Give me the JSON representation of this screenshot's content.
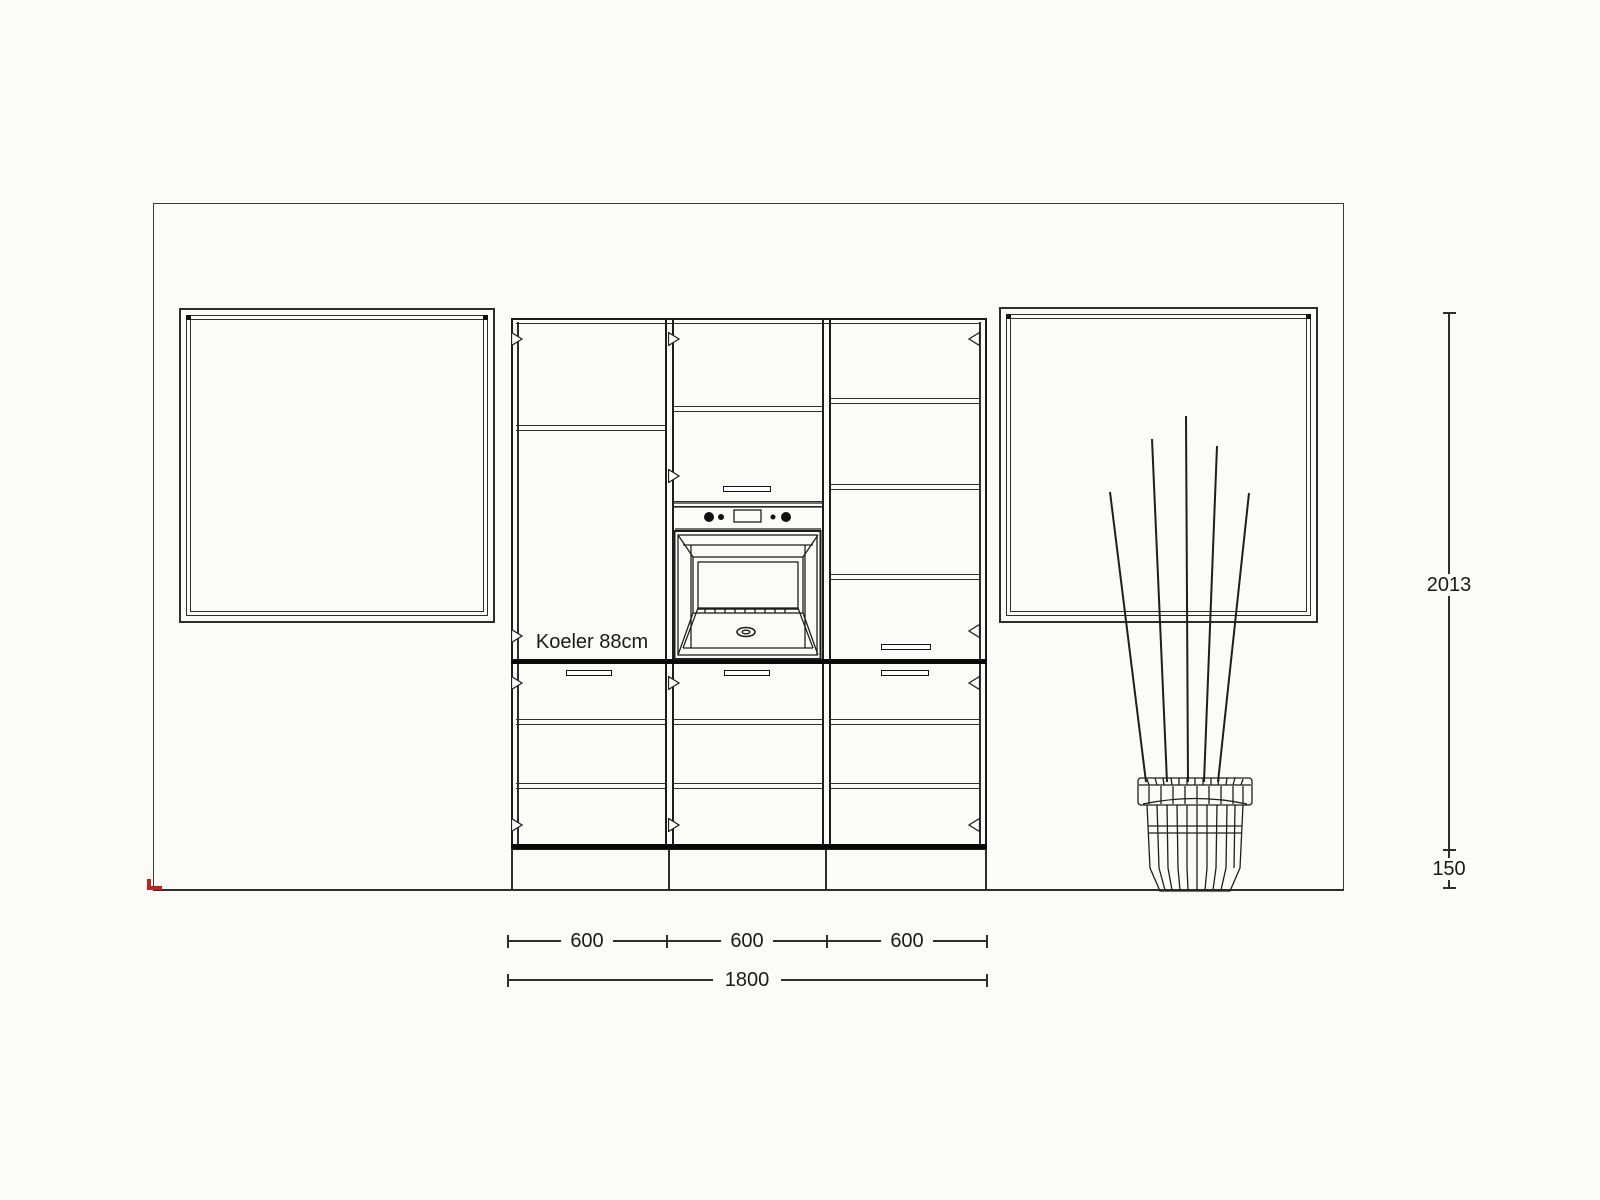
{
  "drawing": {
    "labels": {
      "fridge": "Koeler 88cm"
    },
    "dimensions": {
      "width_segments": [
        "600",
        "600",
        "600"
      ],
      "total_width": "1800",
      "cabinet_height": "2013",
      "plinth_height": "150"
    },
    "colors": {
      "line": "#2e2e2e",
      "bold_line": "#0a0a0a",
      "accent_red": "#c0231e",
      "background": "#fbfbf8"
    }
  }
}
